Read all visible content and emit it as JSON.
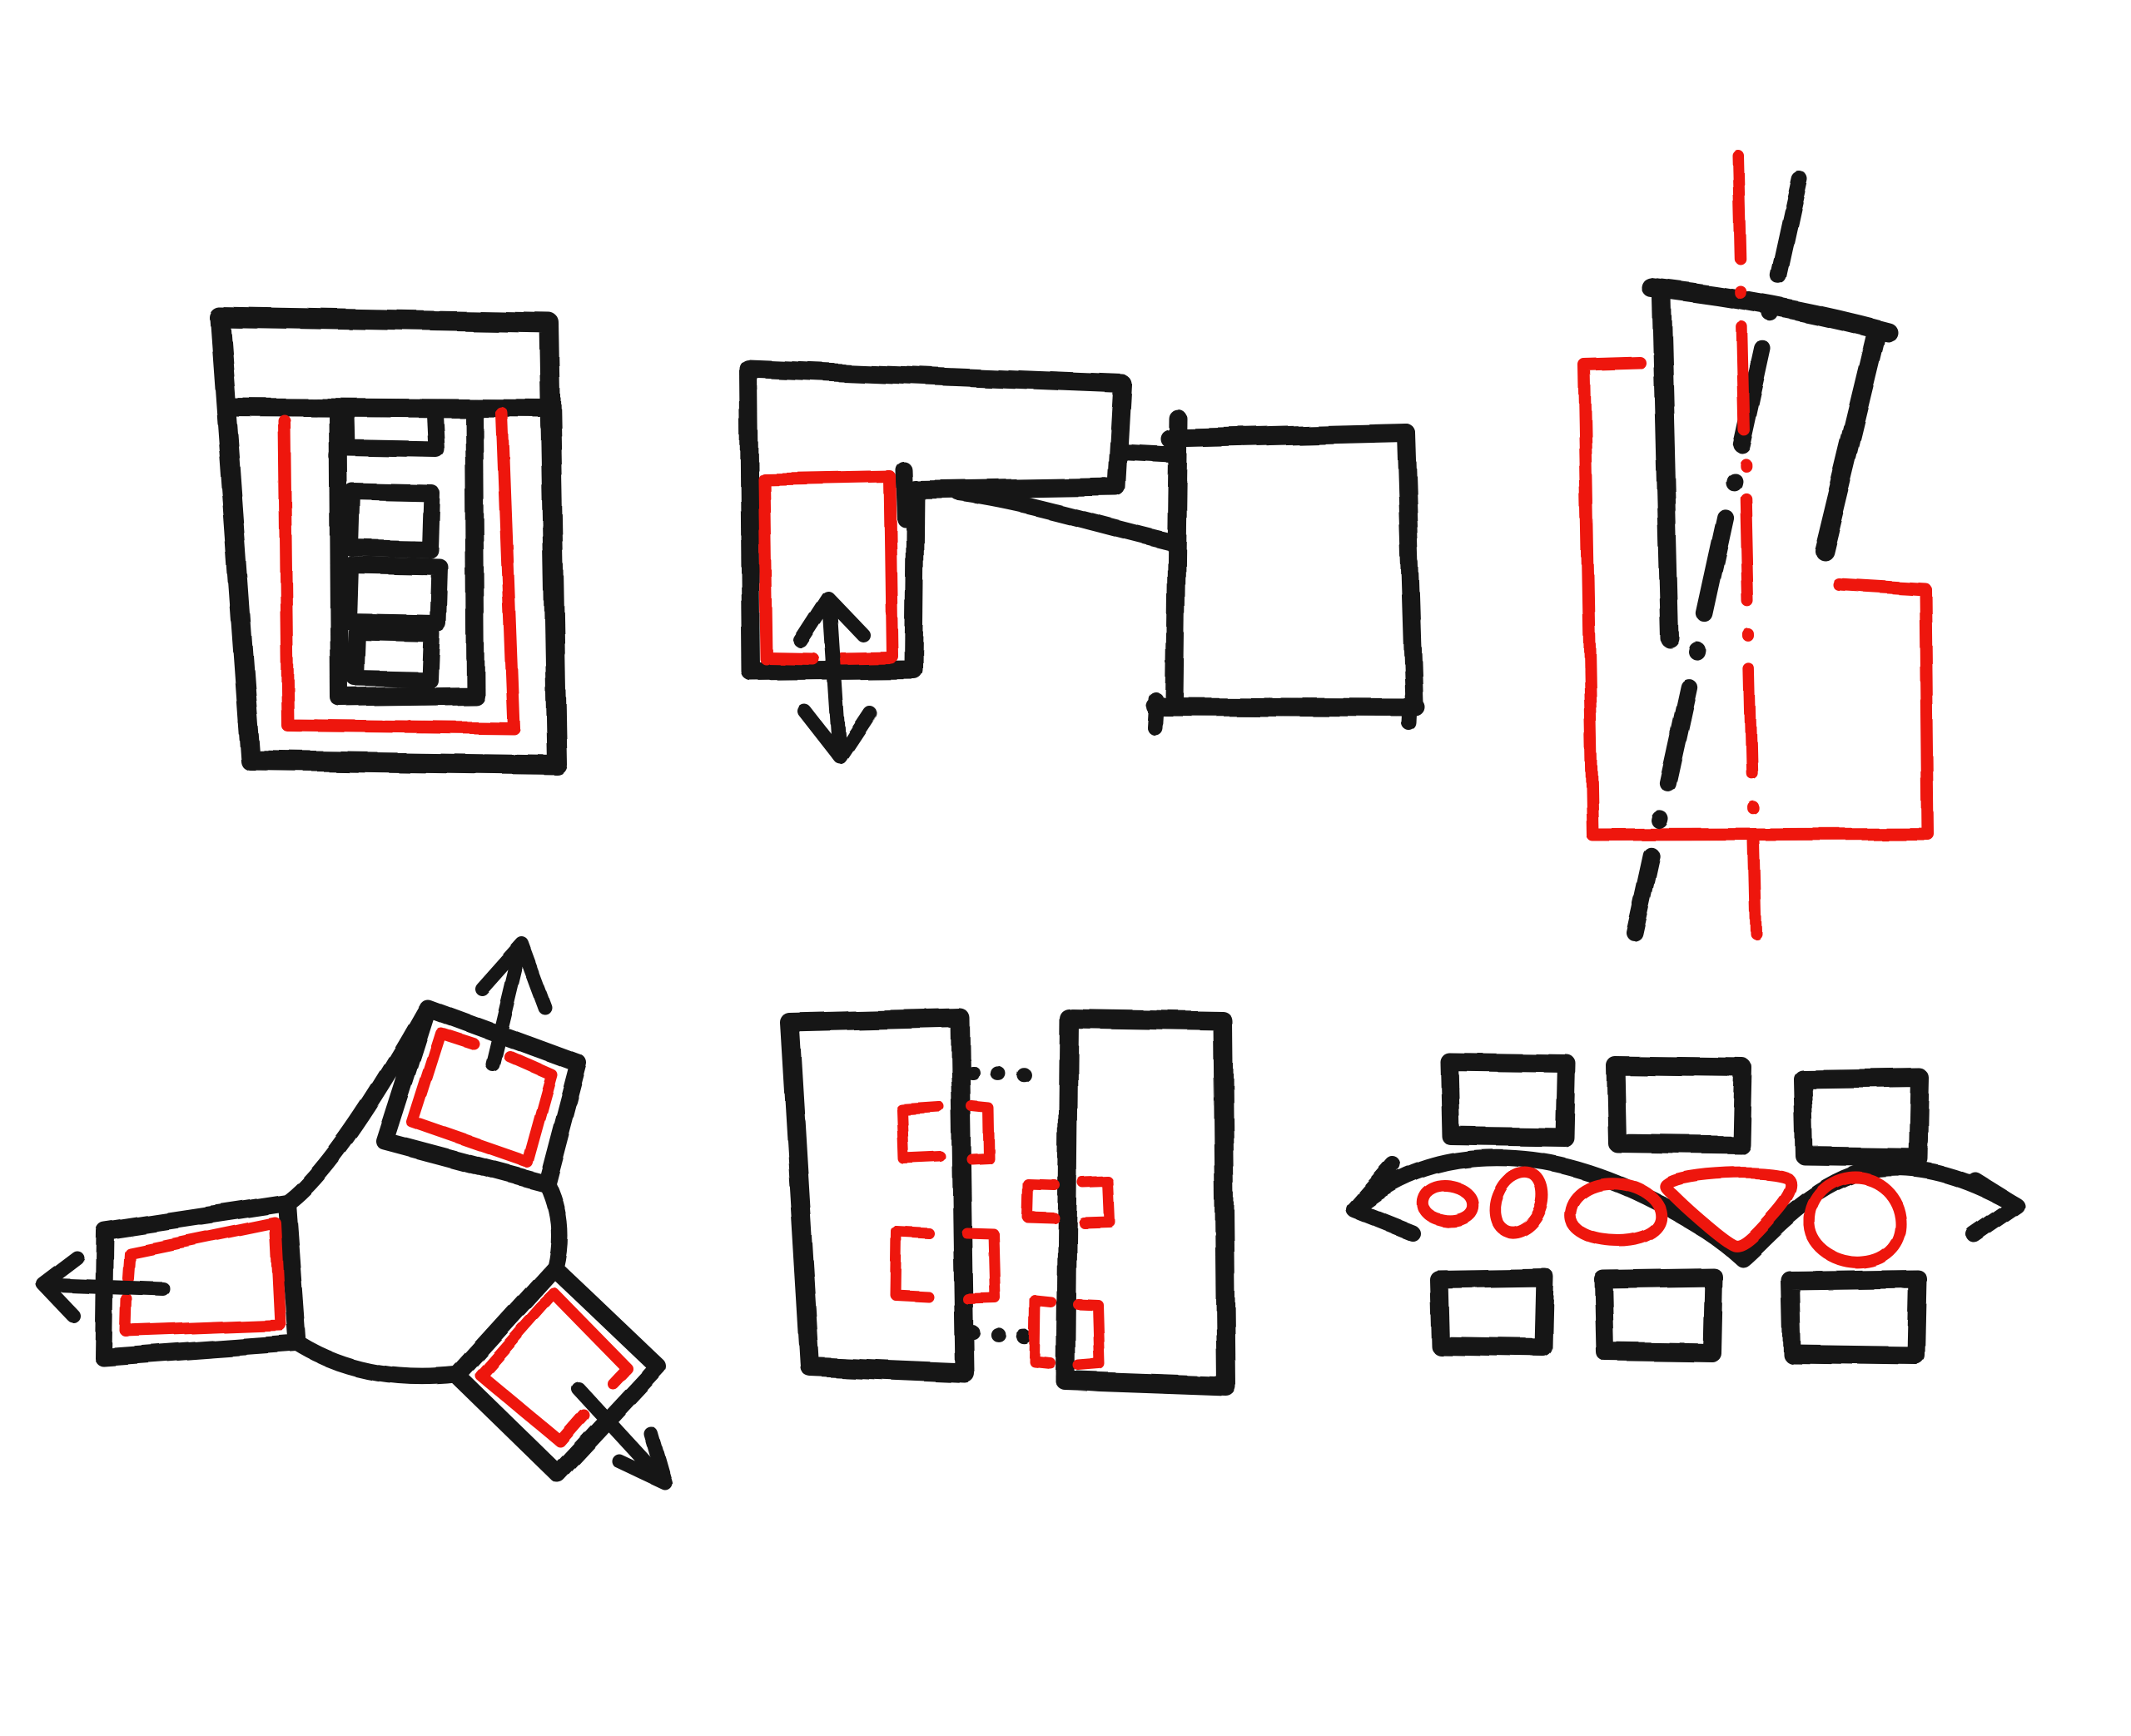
{
  "page": {
    "title": "Hand-drawn architectural concept sketch sheet",
    "background": "#ffffff"
  },
  "colors": {
    "ink": "#141414",
    "accent": "#ee1310",
    "paper": "#ffffff"
  },
  "diagrams": [
    {
      "id": "courtyard-block",
      "label": "Walled block plan with top header band, red inset boundary line and a stacked core of four rooms"
    },
    {
      "id": "l-shaped-extension",
      "label": "L-shaped volume holding a red infill panel with a double-headed extension arrow, tied by a link line and a curve to a detached block"
    },
    {
      "id": "shifted-tower",
      "label": "Tilted open tower outline over a red stepped footprint, crossed by a black and a red dash-dot datum axis"
    },
    {
      "id": "three-arm-pinwheel",
      "label": "Three-armed pinwheel plan, each arm holding a red room pushed outward by an arrow"
    },
    {
      "id": "paired-bars",
      "label": "Two parallel bars joined by dotted ties with four pairs of red bracket joints along their edges"
    },
    {
      "id": "weaving-path",
      "label": "Double-headed wavy path weaving between two rows of three blocks, passing five red organic spaces"
    }
  ]
}
